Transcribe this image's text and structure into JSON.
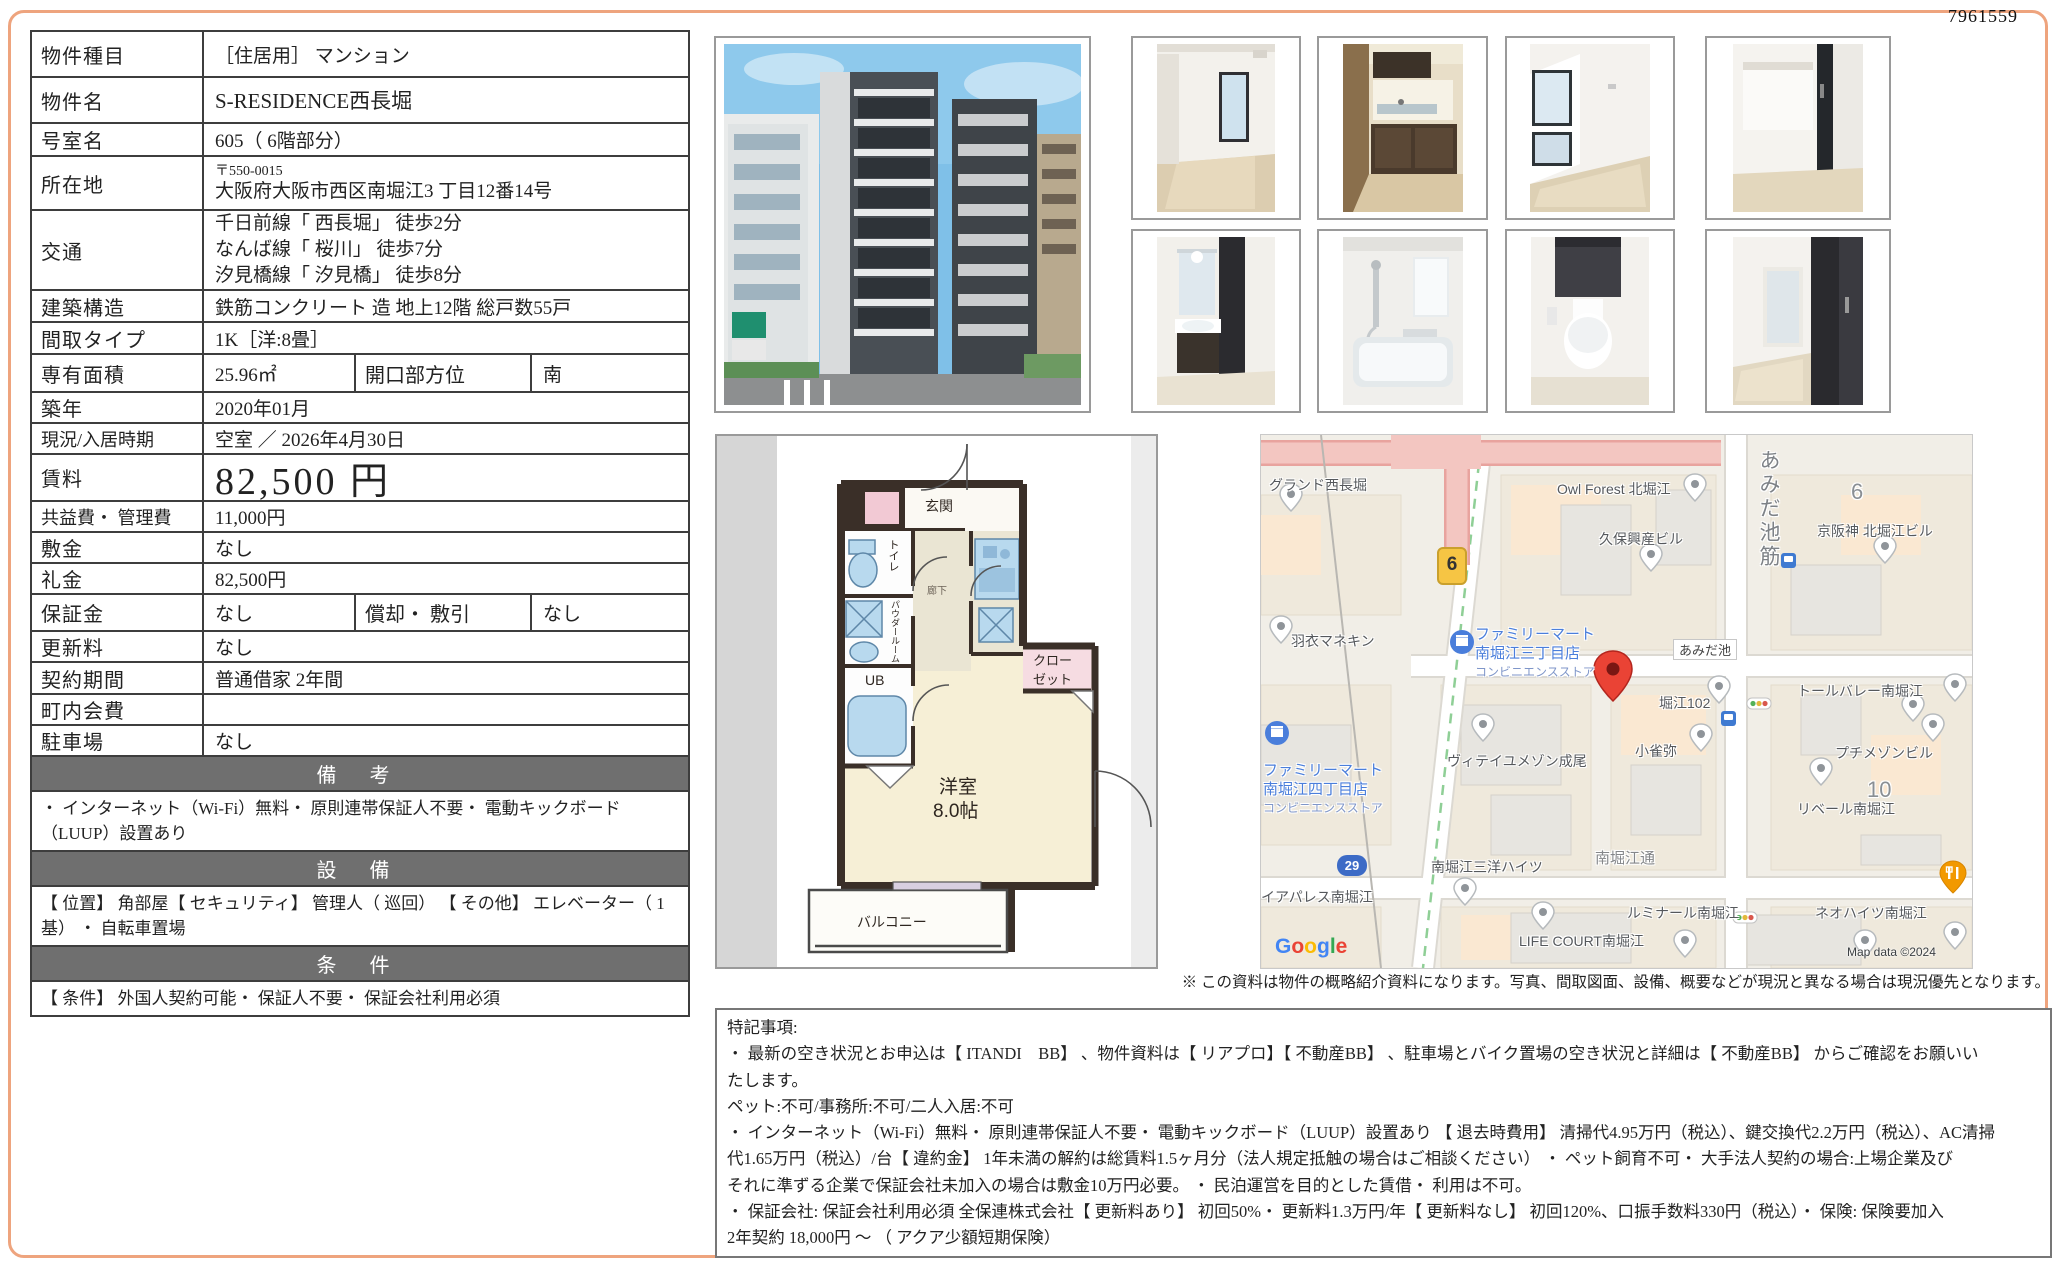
{
  "doc_id": "7961559",
  "colors": {
    "page_border": "#eea47e",
    "section_band": "#6f6f6f",
    "map_poi_blue": "#4a7edb",
    "pin_red": "#ea4335",
    "plan_wall": "#3a2f28"
  },
  "table": {
    "type": {
      "label": "物件種目",
      "value": "［住居用］ マンション"
    },
    "name": {
      "label": "物件名",
      "value": "S-RESIDENCE西長堀"
    },
    "room": {
      "label": "号室名",
      "value": "605（ 6階部分）"
    },
    "address": {
      "label": "所在地",
      "postal": "〒550-0015",
      "value": "大阪府大阪市西区南堀江3 丁目12番14号"
    },
    "access": {
      "label": "交通",
      "line1": "千日前線「 西長堀」 徒歩2分",
      "line2": "なんば線「 桜川」 徒歩7分",
      "line3": "汐見橋線「 汐見橋」 徒歩8分"
    },
    "structure": {
      "label": "建築構造",
      "value": "鉄筋コンクリート 造 地上12階 総戸数55戸"
    },
    "layout": {
      "label": "間取タイプ",
      "value": "1K［洋:8畳］"
    },
    "area": {
      "label": "専有面積",
      "value": "25.96㎡",
      "label2": "開口部方位",
      "value2": "南"
    },
    "built": {
      "label": "築年",
      "value": "2020年01月"
    },
    "status": {
      "label": "現況/入居時期",
      "value": "空室 ／ 2026年4月30日"
    },
    "rent": {
      "label": "賃料",
      "value": "82,500 円"
    },
    "fee": {
      "label": "共益費・ 管理費",
      "value": "11,000円"
    },
    "deposit": {
      "label": "敷金",
      "value": "なし"
    },
    "keymoney": {
      "label": "礼金",
      "value": "82,500円"
    },
    "guarantee": {
      "label": "保証金",
      "value": "なし",
      "label2": "償却・ 敷引",
      "value2": "なし"
    },
    "renewal": {
      "label": "更新料",
      "value": "なし"
    },
    "term": {
      "label": "契約期間",
      "value": "普通借家 2年間"
    },
    "chonaikai": {
      "label": "町内会費",
      "value": ""
    },
    "parking": {
      "label": "駐車場",
      "value": "なし"
    }
  },
  "sections": {
    "remarks": {
      "title": "備 考",
      "text": "・ インターネット（Wi-Fi）無料・ 原則連帯保証人不要・ 電動キックボード（LUUP）設置あり"
    },
    "equipment": {
      "title": "設 備",
      "text": "【 位置】 角部屋【 セキュリティ】 管理人（ 巡回） 【 その他】 エレベーター（ 1基） ・ 自転車置場"
    },
    "conditions": {
      "title": "条 件",
      "text": "【 条件】 外国人契約可能・ 保証人不要・ 保証会社利用必須"
    }
  },
  "floorplan": {
    "genkan": "玄関",
    "toilet": "トイレ",
    "powder": "パウダールーム",
    "ub": "UB",
    "hall": "廊下",
    "closet1": "クロー",
    "closet2": "ゼット",
    "room": "洋室",
    "size": "8.0帖",
    "balcony": "バルコニー"
  },
  "map": {
    "labels": [
      {
        "text": "グランド西長堀"
      },
      {
        "text": "Owl Forest 北堀江"
      },
      {
        "text": "久保興産ビル"
      },
      {
        "text": "京阪神 北堀江ビル"
      },
      {
        "text": "あみだ池"
      },
      {
        "text": "羽衣マネキン"
      },
      {
        "text": "堀江102"
      },
      {
        "text": "トールバレー南堀江"
      },
      {
        "text": "ヴィテイユメゾン成尾"
      },
      {
        "text": "小雀弥"
      },
      {
        "text": "プチメゾンビル"
      },
      {
        "text": "リベール南堀江"
      },
      {
        "text": "イアパレス南堀江"
      },
      {
        "text": "南堀江三洋ハイツ"
      },
      {
        "text": "ルミナール南堀江"
      },
      {
        "text": "ネオハイツ南堀江"
      },
      {
        "text": "LIFE COURT南堀江"
      },
      {
        "text": "南堀江通"
      },
      {
        "text": "あみだ池筋"
      },
      {
        "text": "6"
      },
      {
        "text": "10"
      }
    ],
    "famima3": {
      "l1": "ファミリーマート",
      "l2": "南堀江三丁目店",
      "l3": "コンビニエンスストア"
    },
    "famima4": {
      "l1": "ファミリーマート",
      "l2": "南堀江四丁目店",
      "l3": "コンビニエンスストア"
    },
    "shield_route6": "6",
    "shield_route29": "29",
    "google_letters": [
      "G",
      "o",
      "o",
      "g",
      "l",
      "e"
    ],
    "copyright": "Map data ©2024"
  },
  "disclaimer": "※ この資料は物件の概略紹介資料になります。写真、間取図面、設備、概要などが現況と異なる場合は現況優先となります。",
  "notes": {
    "lines": [
      "特記事項:",
      "・ 最新の空き状況とお申込は【 ITANDI　BB】 、物件資料は【 リアプロ】【 不動産BB】 、駐車場とバイク置場の空き状況と詳細は【 不動産BB】 からご確認をお願いい",
      "たします。",
      "ペット:不可/事務所:不可/二人入居:不可",
      "・ インターネット（Wi-Fi）無料・ 原則連帯保証人不要・ 電動キックボード（LUUP）設置あり 【 退去時費用】 清掃代4.95万円（税込）、鍵交換代2.2万円（税込）、AC清掃",
      "代1.65万円（税込）/台【 違約金】 1年未満の解約は総賃料1.5ヶ月分（法人規定抵触の場合はご相談ください） ・ ペット飼育不可・ 大手法人契約の場合:上場企業及び",
      "それに準ずる企業で保証会社未加入の場合は敷金10万円必要。 ・ 民泊運営を目的とした賃借・ 利用は不可。",
      "・ 保証会社: 保証会社利用必須 全保連株式会社【 更新料あり】 初回50%・ 更新料1.3万円/年【 更新料なし】 初回120%、口振手数料330円（税込）・ 保険: 保険要加入",
      " 2年契約 18,000円 ～ （ アクア少額短期保険）"
    ]
  }
}
